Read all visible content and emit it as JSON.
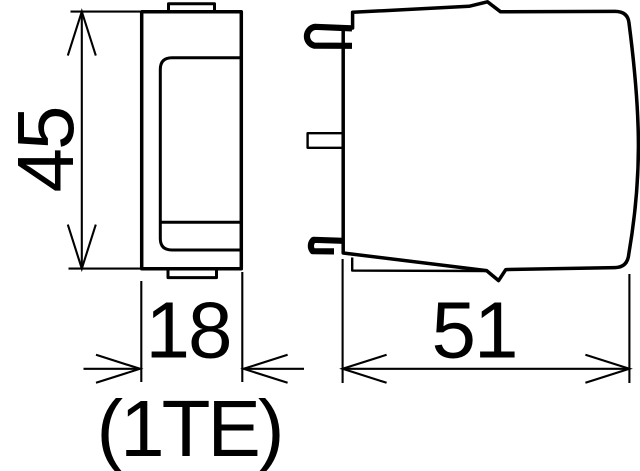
{
  "drawing": {
    "kind": "technical-dimension-drawing",
    "colors": {
      "line": "#000000",
      "background": "#ffffff"
    },
    "dimensions": {
      "height": {
        "label": "45"
      },
      "width": {
        "label": "18"
      },
      "width_note": {
        "label": "(1TE)"
      },
      "depth": {
        "label": "51"
      }
    }
  }
}
